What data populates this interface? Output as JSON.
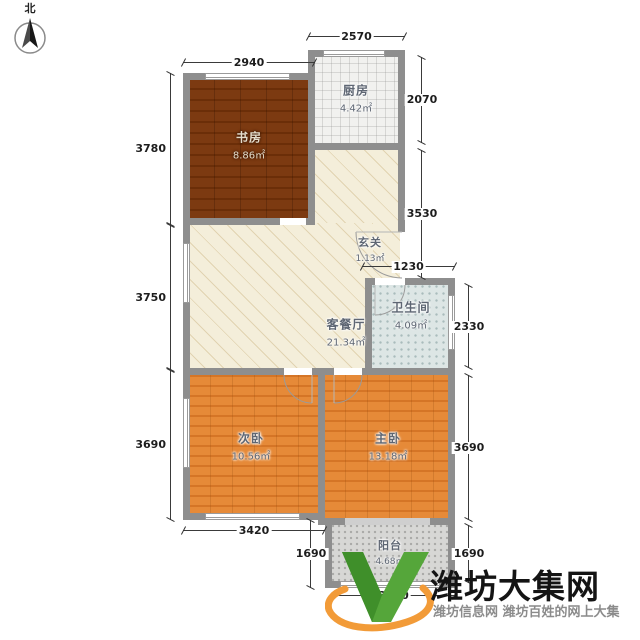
{
  "compass": {
    "label": "北"
  },
  "rooms": {
    "study": {
      "name": "书房",
      "area": "8.86㎡"
    },
    "kitchen": {
      "name": "厨房",
      "area": "4.42㎡"
    },
    "entry": {
      "name": "玄关",
      "area": "1.13㎡"
    },
    "living": {
      "name": "客餐厅",
      "area": "21.34㎡"
    },
    "bath": {
      "name": "卫生间",
      "area": "4.09㎡"
    },
    "second_bedroom": {
      "name": "次卧",
      "area": "10.56㎡"
    },
    "master_bedroom": {
      "name": "主卧",
      "area": "13.18㎡"
    },
    "balcony": {
      "name": "阳台",
      "area": "4.68㎡"
    }
  },
  "dims": {
    "study_top": "2940",
    "kitchen_top": "2570",
    "left_study": "3780",
    "left_living": "3750",
    "left_second": "3690",
    "right_kitchen": "2070",
    "right_corridor": "3530",
    "entry_width": "1230",
    "right_bath": "2330",
    "right_master": "3690",
    "right_balcony": "1690",
    "second_bottom": "3420",
    "balcony_left": "1690",
    "balcony_bottom": "3330"
  },
  "watermark": {
    "title": "潍坊大集网",
    "subtitle": "潍坊信息网 潍坊百姓的网上大集"
  },
  "colors": {
    "wall": "#8e8e8e",
    "study_floor": "#7c3a11",
    "bedroom_floor": "#e68a38",
    "living_floor": "#f4eeda",
    "bath_floor": "#dde6e5",
    "balcony_floor": "#d7d7d5",
    "logo_green": "#55a63a",
    "logo_orange": "#f29b38"
  }
}
